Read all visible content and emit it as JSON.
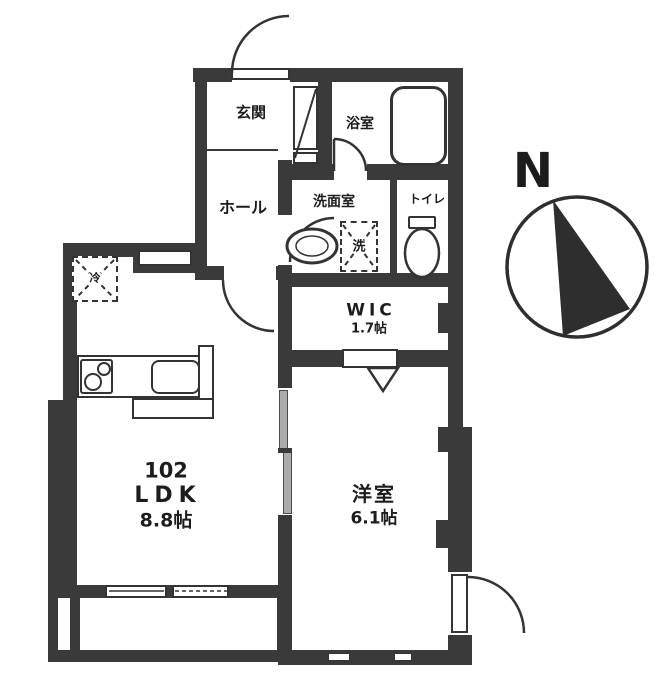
{
  "plan_title": "floor-plan",
  "rooms": {
    "genkan": {
      "label": "玄関"
    },
    "bath": {
      "label": "浴室"
    },
    "hall": {
      "label": "ホール"
    },
    "washroom": {
      "label": "洗面室"
    },
    "toilet": {
      "label": "トイレ"
    },
    "wic": {
      "label": "WIC",
      "size": "1.7帖"
    },
    "ldk": {
      "number": "102",
      "label": "LDK",
      "size": "8.8帖"
    },
    "western": {
      "label": "洋室",
      "size": "6.1帖"
    }
  },
  "symbols": {
    "washer": "洗",
    "fridge": "冷"
  },
  "compass": {
    "north": "N"
  },
  "colors": {
    "wall": "#3a3a3a",
    "background": "#ffffff",
    "door_panel": "#acacac",
    "line": "#333333"
  }
}
